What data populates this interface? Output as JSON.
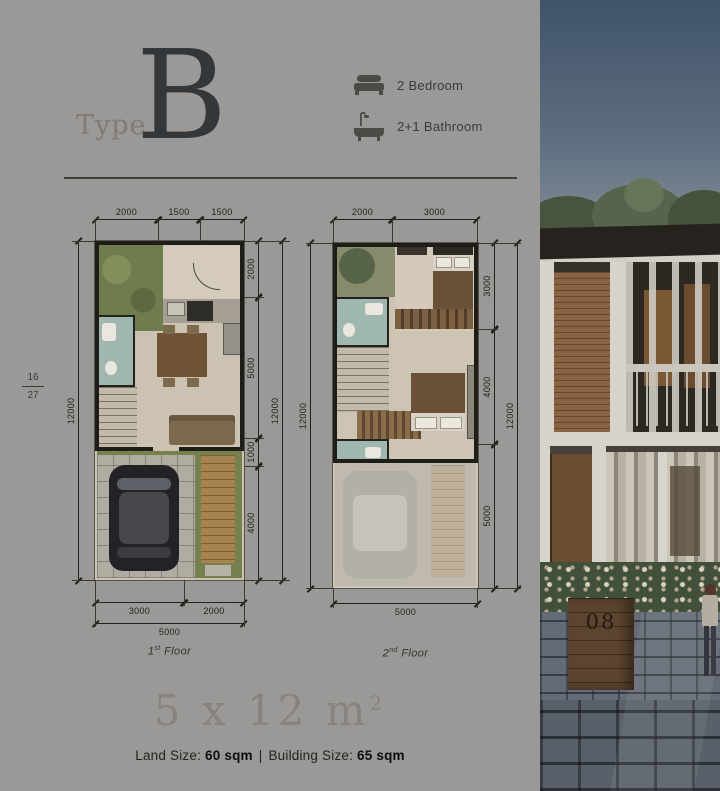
{
  "header": {
    "type_label": "Type",
    "type_letter": "B",
    "amenities": [
      {
        "icon": "bed-icon",
        "label": "2 Bedroom"
      },
      {
        "icon": "bathtub-icon",
        "label": "2+1 Bathroom"
      }
    ]
  },
  "page_indicator": {
    "current": "16",
    "total": "27"
  },
  "plans": [
    {
      "floor_label": {
        "num": "1",
        "sup": "st",
        "word": "Floor"
      },
      "top_dims": [
        "2000",
        "1500",
        "1500"
      ],
      "left_dim": "12000",
      "right_inner_dims": [
        "2000",
        "5000",
        "1000",
        "4000"
      ],
      "right_outer_dim": "12000",
      "bottom_inner_dims": [
        "3000",
        "2000"
      ],
      "bottom_outer_dim": "5000"
    },
    {
      "floor_label": {
        "num": "2",
        "sup": "nd",
        "word": "Floor"
      },
      "top_dims": [
        "2000",
        "3000"
      ],
      "left_dim": "12000",
      "right_inner_dims": [
        "3000",
        "4000",
        "5000"
      ],
      "right_outer_dim": "12000",
      "bottom_outer_dim": "5000"
    }
  ],
  "footer": {
    "dimensions": "5 x 12 m",
    "dimensions_sup": "2",
    "land_label": "Land Size:",
    "land_value": "60 sqm",
    "divider": "|",
    "building_label": "Building Size:",
    "building_value": "65 sqm"
  },
  "photo": {
    "house_number": "08"
  },
  "colors": {
    "background": "#9b9997",
    "title": "#33373a",
    "dimension_lines": "#23221e",
    "garden_green": "#6f7c4e",
    "bath_teal": "#9fb7ae",
    "wood_deck": "#a8834f",
    "floor_beige": "#cbc2b2"
  }
}
